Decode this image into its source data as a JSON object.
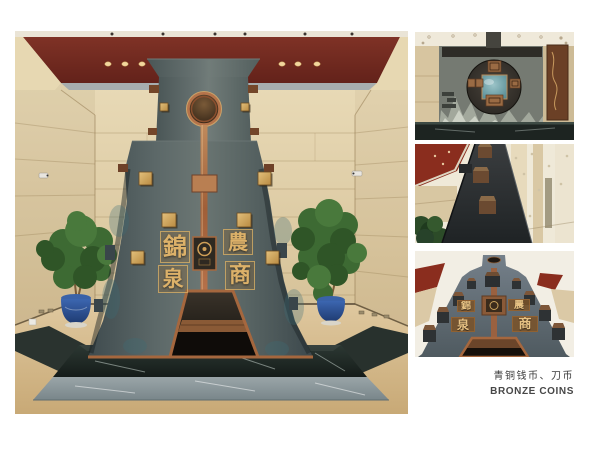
{
  "caption": {
    "title_zh": "青铜钱币、刀币",
    "title_en": "BRONZE COINS"
  },
  "sculpture": {
    "characters": [
      "錦",
      "泉",
      "農",
      "商"
    ]
  },
  "colors": {
    "background": "#ffffff",
    "ceiling_red": "#7a2c20",
    "wall_beige": "#ddc9a1",
    "stone_body": "#515d5f",
    "copper": "#b0714a",
    "gold": "#cfa45c",
    "marble_dark": "#232b27",
    "marble_step_gray": "#8a9497",
    "pot_blue": "#2d4f8e",
    "plant_green": "#3c6434",
    "caption_text": "#3b3b3b"
  }
}
